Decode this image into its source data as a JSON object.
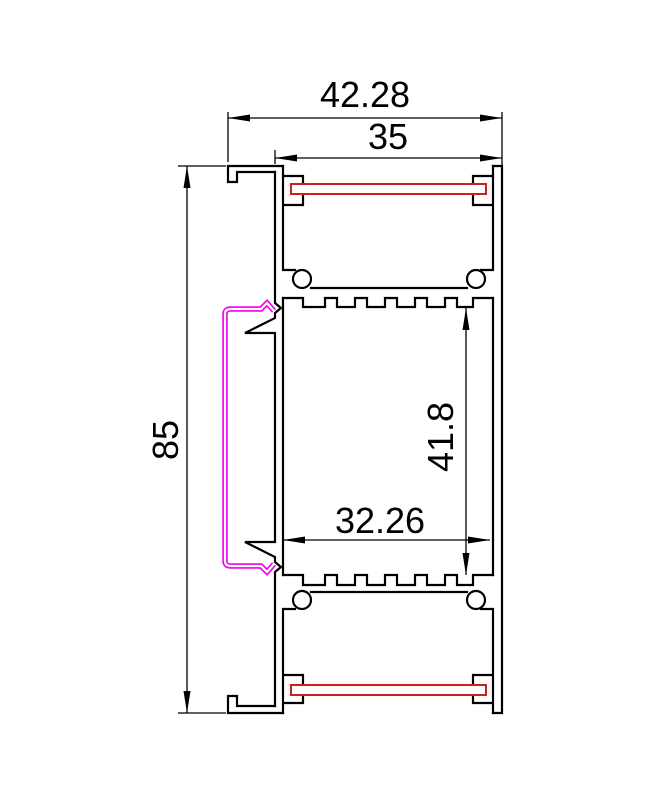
{
  "drawing": {
    "title": "aluminium-profile-cross-section",
    "dimensions": {
      "overall_width": "42.28",
      "body_width": "35",
      "overall_height": "85",
      "inner_height": "41.8",
      "inner_width": "32.26"
    },
    "colors": {
      "outline": "#000000",
      "strip": "#cc2020",
      "cover_clip": "#ee00ee",
      "background": "#ffffff"
    }
  }
}
